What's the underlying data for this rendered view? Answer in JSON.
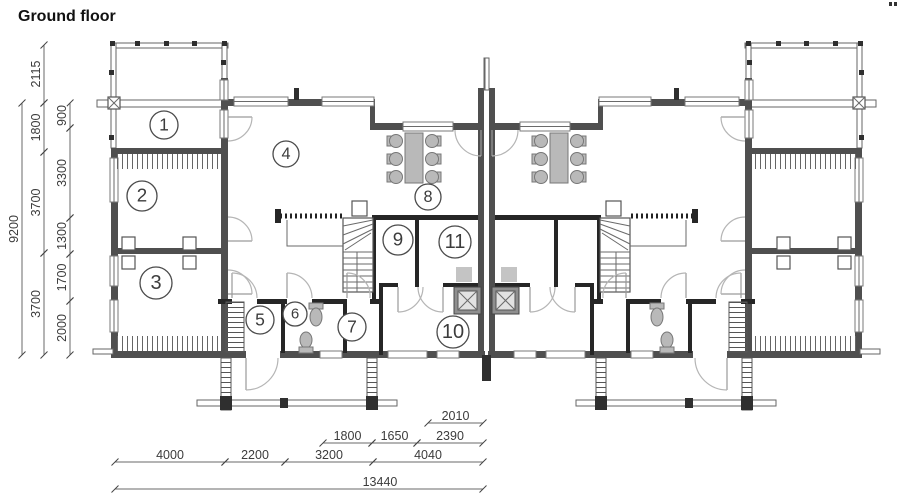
{
  "title": "Ground floor",
  "colors": {
    "exterior_wall": "#4f4f4f",
    "partition_wall": "#262626",
    "furniture_gray": "#b9b9b9",
    "fireplace_gray": "#8f8f8f",
    "dimension_text": "#3c3c3c",
    "line_gray": "#6a6a6a"
  },
  "plan": {
    "rooms": [
      {
        "number": "1",
        "cx": 164,
        "cy": 125,
        "r": 14
      },
      {
        "number": "2",
        "cx": 142,
        "cy": 196,
        "r": 15
      },
      {
        "number": "3",
        "cx": 156,
        "cy": 283,
        "r": 16
      },
      {
        "number": "4",
        "cx": 286,
        "cy": 154,
        "r": 13
      },
      {
        "number": "5",
        "cx": 260,
        "cy": 320,
        "r": 14
      },
      {
        "number": "6",
        "cx": 295,
        "cy": 314,
        "r": 12
      },
      {
        "number": "7",
        "cx": 352,
        "cy": 327,
        "r": 14
      },
      {
        "number": "8",
        "cx": 428,
        "cy": 197,
        "r": 13
      },
      {
        "number": "9",
        "cx": 398,
        "cy": 240,
        "r": 15
      },
      {
        "number": "10",
        "cx": 453,
        "cy": 332,
        "r": 16
      },
      {
        "number": "11",
        "cx": 455,
        "cy": 242,
        "r": 16
      }
    ],
    "dimensions": {
      "left_chains": [
        {
          "x": 22,
          "segments": [
            {
              "label": "9200",
              "y1": 103,
              "y2": 355
            }
          ]
        },
        {
          "x": 44,
          "segments": [
            {
              "label": "2115",
              "y1": 45,
              "y2": 103
            },
            {
              "label": "1800",
              "y1": 103,
              "y2": 152
            },
            {
              "label": "3700",
              "y1": 152,
              "y2": 253
            },
            {
              "label": "3700",
              "y1": 253,
              "y2": 355
            }
          ]
        },
        {
          "x": 70,
          "segments": [
            {
              "label": "900",
              "y1": 103,
              "y2": 128
            },
            {
              "label": "3300",
              "y1": 128,
              "y2": 218
            },
            {
              "label": "1300",
              "y1": 218,
              "y2": 254
            },
            {
              "label": "1700",
              "y1": 254,
              "y2": 301
            },
            {
              "label": "2000",
              "y1": 301,
              "y2": 355
            }
          ]
        }
      ],
      "bottom_chains": [
        {
          "y": 423,
          "segments": [
            {
              "label": "2010",
              "x1": 428,
              "x2": 483
            }
          ]
        },
        {
          "y": 443,
          "segments": [
            {
              "label": "1800",
              "x1": 323,
              "x2": 372
            },
            {
              "label": "1650",
              "x1": 372,
              "x2": 417
            },
            {
              "label": "2390",
              "x1": 417,
              "x2": 483
            }
          ]
        },
        {
          "y": 462,
          "segments": [
            {
              "label": "4000",
              "x1": 115,
              "x2": 225
            },
            {
              "label": "2200",
              "x1": 225,
              "x2": 285
            },
            {
              "label": "3200",
              "x1": 285,
              "x2": 373
            },
            {
              "label": "4040",
              "x1": 373,
              "x2": 483
            }
          ]
        },
        {
          "y": 489,
          "segments": [
            {
              "label": "13440",
              "x1": 115,
              "x2": 483,
              "lx": 380
            }
          ]
        }
      ]
    }
  }
}
